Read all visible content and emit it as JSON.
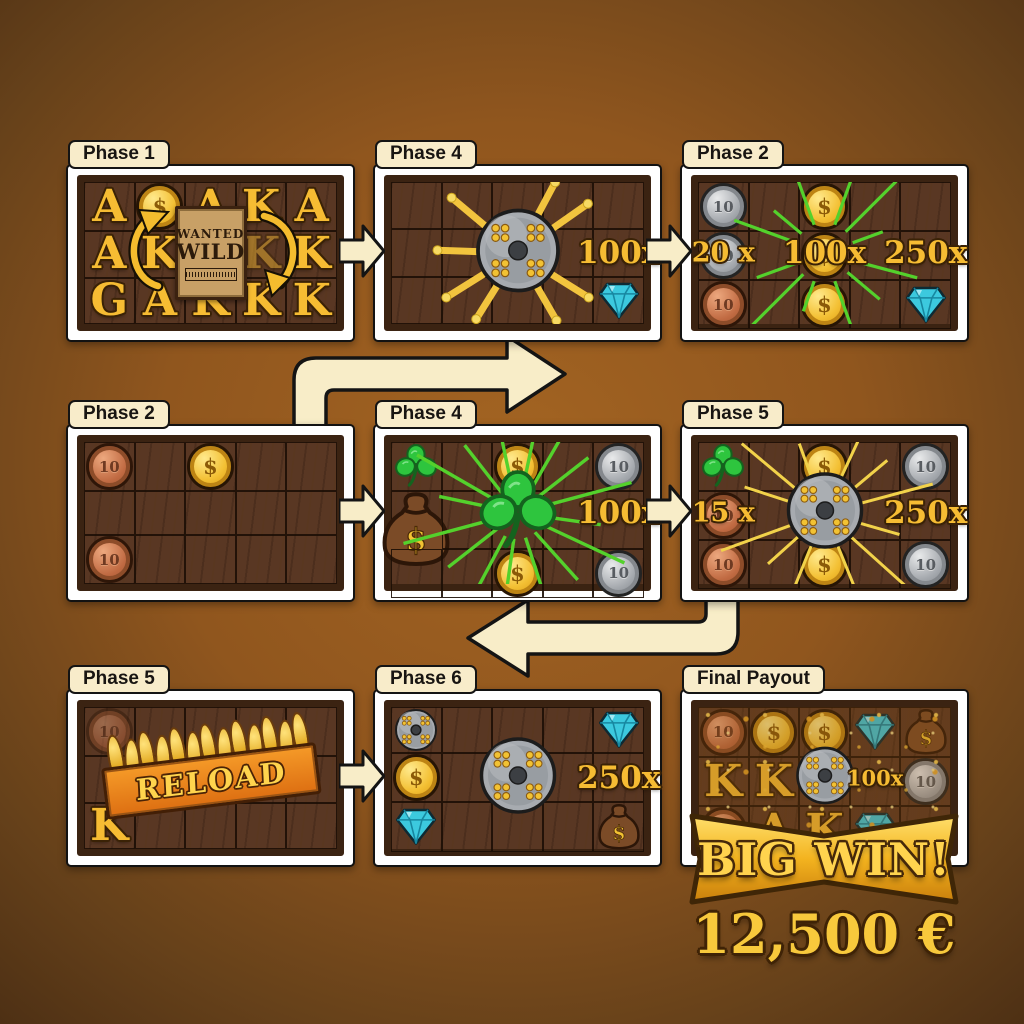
{
  "big_win": {
    "banner": "BIG WIN!",
    "amount": "12,500 €"
  },
  "symbols": {
    "gold_coin_glyph": "$",
    "coin_value": "10",
    "wild_poster": {
      "line1": "WANTED",
      "line2": "WILD"
    },
    "reload_label": "RELOAD"
  },
  "colors": {
    "background_center": "#a36422",
    "background_edge": "#452a12",
    "panel_frame": "#ffffff",
    "wood": "#593723",
    "arrow_fill": "#f8edc8",
    "ray_green": "#54d12c",
    "ray_yellow": "#f2d24a",
    "gold": "#f6bc33",
    "banner_orange": "#e8821c",
    "diamond_cyan": "#3cc9de",
    "clover_green": "#2ec53e"
  },
  "panels": [
    {
      "label": "Phase 1",
      "cells": [
        [
          "A",
          "coin-dollar",
          "A",
          "K",
          "A"
        ],
        [
          "A",
          "K",
          null,
          "K-faded",
          "K"
        ],
        [
          "G",
          "A",
          "K",
          "K",
          "K"
        ]
      ],
      "center": {
        "type": "wild-poster"
      },
      "rays": null,
      "badges": [],
      "special": "swap-arrows"
    },
    {
      "label": "Phase 4",
      "cells": [
        [
          null,
          null,
          null,
          null,
          null
        ],
        [
          null,
          null,
          null,
          null,
          null
        ],
        [
          null,
          null,
          null,
          null,
          "diamond"
        ]
      ],
      "center": {
        "type": "wheel",
        "scale": 1.9
      },
      "rays": "yellow-comet",
      "badges": [
        {
          "text": "100x",
          "row": 1,
          "col": 4,
          "size": "lg"
        }
      ],
      "special": null
    },
    {
      "label": "Phase 2",
      "cells": [
        [
          "coin-silver",
          null,
          "coin-dollar",
          null,
          null
        ],
        [
          "coin-silver",
          null,
          "coin-dollar",
          null,
          null
        ],
        [
          "coin-copper",
          null,
          "coin-dollar",
          null,
          "diamond"
        ]
      ],
      "center": null,
      "rays": "green",
      "badges": [
        {
          "text": "20 x",
          "row": 1,
          "col": 0,
          "size": "md"
        },
        {
          "text": "100x",
          "row": 1,
          "col": 2,
          "size": "lg"
        },
        {
          "text": "250x",
          "row": 1,
          "col": 4,
          "size": "lg"
        }
      ],
      "special": null
    },
    {
      "label": "Phase 2",
      "cells": [
        [
          "coin-copper",
          null,
          "coin-dollar",
          null,
          null
        ],
        [
          null,
          null,
          null,
          null,
          null
        ],
        [
          "coin-copper",
          null,
          null,
          null,
          null
        ]
      ],
      "center": null,
      "rays": null,
      "badges": [],
      "special": null
    },
    {
      "label": "Phase 4",
      "cells": [
        [
          "clover",
          null,
          "coin-dollar",
          null,
          "coin-silver"
        ],
        [
          "moneybag-lg",
          null,
          null,
          null,
          null
        ],
        [
          null,
          null,
          "coin-dollar",
          null,
          "coin-silver"
        ]
      ],
      "center": {
        "type": "clover",
        "scale": 1.75
      },
      "rays": "green-long",
      "badges": [
        {
          "text": "100x",
          "row": 1,
          "col": 4,
          "size": "lg"
        }
      ],
      "special": null
    },
    {
      "label": "Phase 5",
      "cells": [
        [
          "clover",
          null,
          "coin-dollar",
          null,
          "coin-silver"
        ],
        [
          "coin-copper",
          null,
          null,
          null,
          null
        ],
        [
          "coin-copper",
          null,
          "coin-dollar",
          null,
          "coin-silver"
        ]
      ],
      "center": {
        "type": "wheel",
        "scale": 1.75
      },
      "rays": "yellow",
      "badges": [
        {
          "text": "15 x",
          "row": 1,
          "col": 0,
          "size": "md"
        },
        {
          "text": "250x",
          "row": 1,
          "col": 4,
          "size": "lg"
        }
      ],
      "special": null
    },
    {
      "label": "Phase 5",
      "cells": [
        [
          "coin-copper-faded",
          null,
          null,
          null,
          null
        ],
        [
          null,
          null,
          null,
          null,
          null
        ],
        [
          "K",
          null,
          null,
          null,
          null
        ]
      ],
      "center": {
        "type": "reload"
      },
      "rays": null,
      "badges": [],
      "special": null
    },
    {
      "label": "Phase 6",
      "cells": [
        [
          "wheel",
          null,
          null,
          null,
          "diamond"
        ],
        [
          "coin-dollar",
          null,
          null,
          null,
          null
        ],
        [
          "diamond",
          null,
          null,
          null,
          "moneybag"
        ]
      ],
      "center": {
        "type": "wheel",
        "scale": 1.75
      },
      "rays": null,
      "badges": [
        {
          "text": "250x",
          "row": 1,
          "col": 4,
          "size": "lg"
        }
      ],
      "special": null
    },
    {
      "label": "Final Payout",
      "cells": [
        [
          "coin-copper",
          "coin-dollar",
          "coin-dollar",
          "diamond",
          "moneybag"
        ],
        [
          "K",
          "K",
          null,
          null,
          "coin-silver"
        ],
        [
          "coin-copper",
          "A",
          "K",
          "diamond",
          null
        ]
      ],
      "center": {
        "type": "wheel",
        "scale": 1.35
      },
      "rays": null,
      "badges": [
        {
          "text": "100x",
          "row": 1,
          "col": 3,
          "size": "sm"
        }
      ],
      "special": "glitter"
    }
  ]
}
